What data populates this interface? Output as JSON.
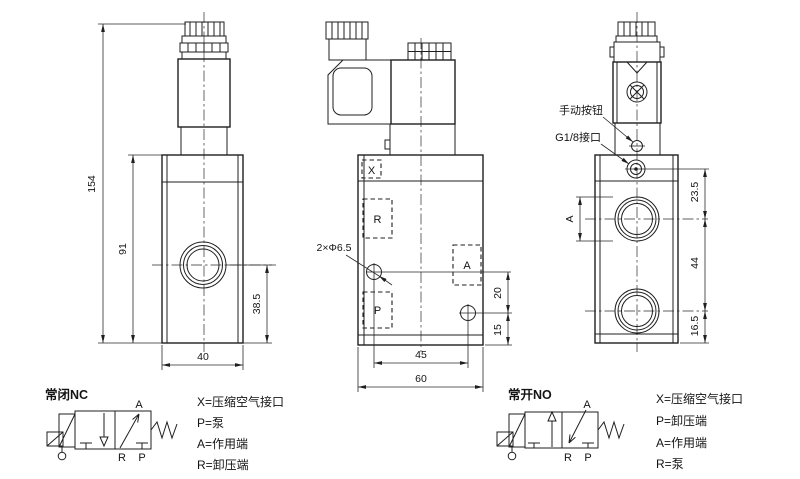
{
  "drawing": {
    "views": {
      "front": {
        "dim_overall_height": "154",
        "dim_body_height": "91",
        "dim_port_height": "38.5",
        "dim_width": "40"
      },
      "side": {
        "port_x": "X",
        "port_r": "R",
        "port_a": "A",
        "port_p": "P",
        "mounting_holes": "2×Φ6.5",
        "dim_hole_spacing": "45",
        "dim_width": "60",
        "dim_hole_offset": "20",
        "dim_hole_bottom": "15"
      },
      "back": {
        "label_manual_button": "手动按钮",
        "label_g18_port": "G1/8接口",
        "dim_port_a": "A",
        "dim_top_to_port": "23.5",
        "dim_port_spacing": "44",
        "dim_port_to_bottom": "16.5"
      }
    },
    "schematic_nc": {
      "title": "常闭NC",
      "port_a": "A",
      "port_r": "R",
      "port_p": "P"
    },
    "schematic_no": {
      "title": "常开NO",
      "port_a": "A",
      "port_r": "R",
      "port_p": "P"
    },
    "legend_nc": {
      "line1": "X=压缩空气接口",
      "line2": "P=泵",
      "line3": "A=作用端",
      "line4": "R=卸压端"
    },
    "legend_no": {
      "line1": "X=压缩空气接口",
      "line2": "P=卸压端",
      "line3": "A=作用端",
      "line4": "R=泵"
    }
  }
}
